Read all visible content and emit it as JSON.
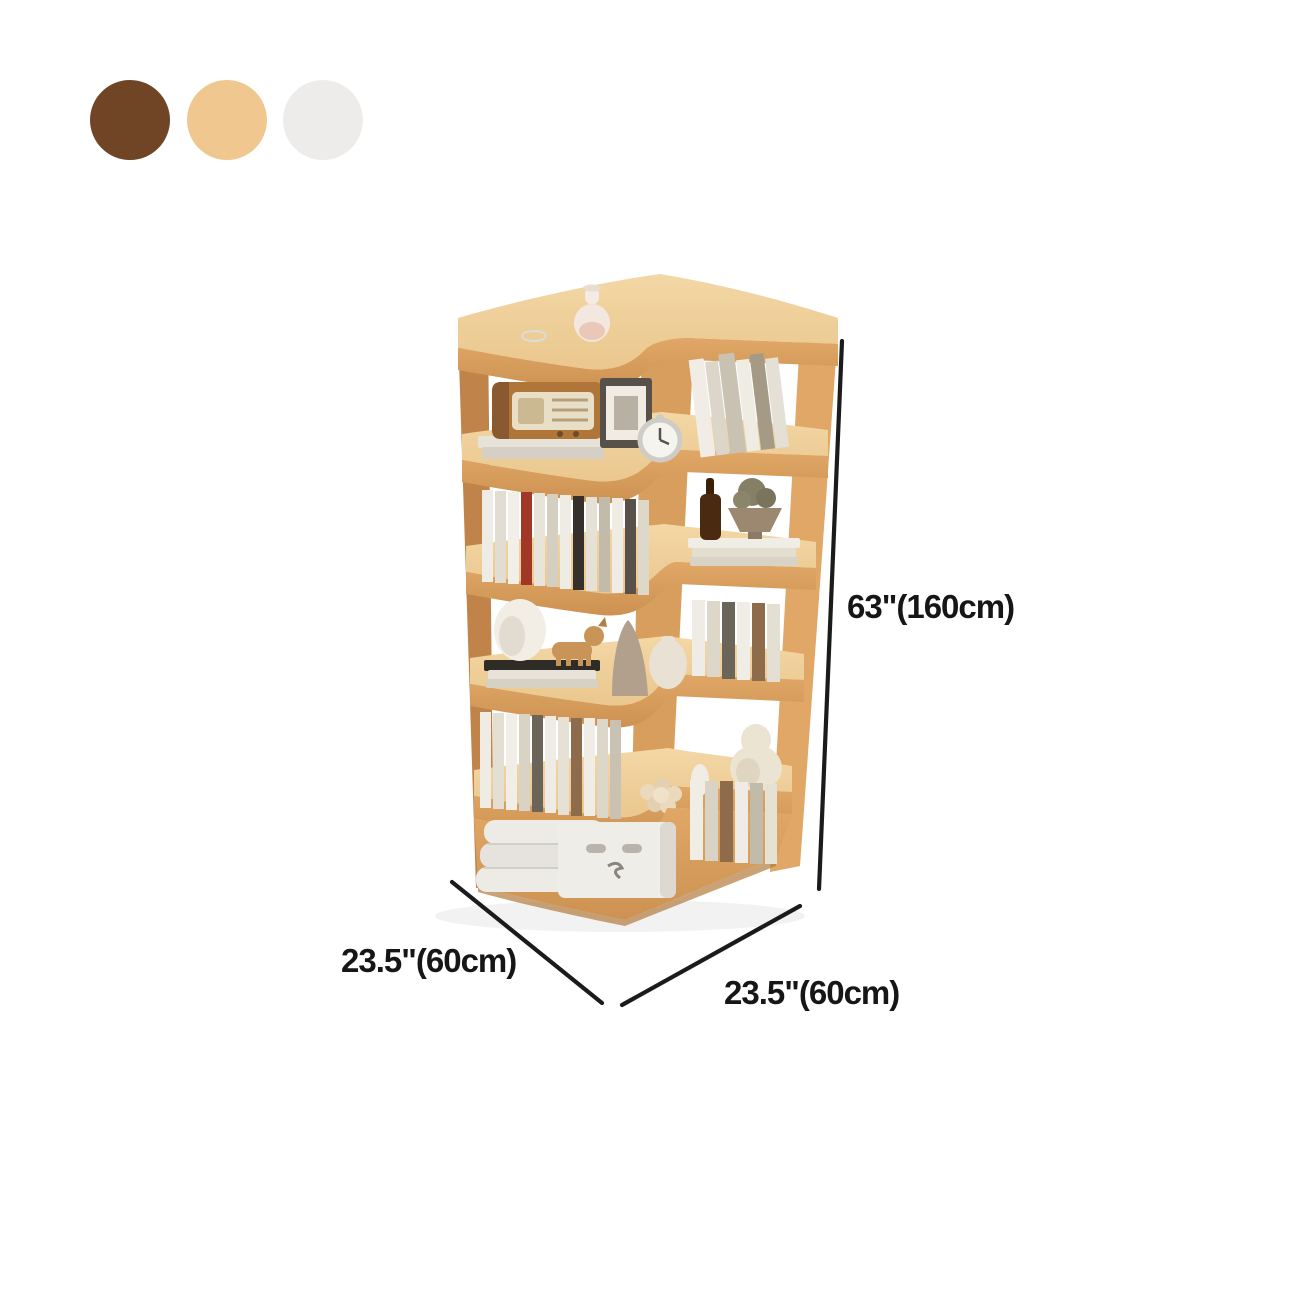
{
  "colors": {
    "bg": "#ffffff",
    "swatch_brown": "#6f4526",
    "swatch_tan": "#f0c78f",
    "swatch_cream": "#edeceA",
    "wood_top_light": "#f3d7a5",
    "wood_top": "#eac78e",
    "wood_front": "#e0a767",
    "wood_front_dark": "#cd9251",
    "wood_side": "#c08349",
    "wood_corner": "#d89e5d",
    "dim_line": "#1b1b1b",
    "dim_text": "#161616"
  },
  "swatches": [
    {
      "name": "dark-brown",
      "color": "#6f4526"
    },
    {
      "name": "light-oak",
      "color": "#f0c78f"
    },
    {
      "name": "cream-white",
      "color": "#edecea"
    }
  ],
  "dimensions": {
    "height_label": "63\"(160cm)",
    "depth_left_label": "23.5\"(60cm)",
    "depth_right_label": "23.5\"(60cm)"
  }
}
